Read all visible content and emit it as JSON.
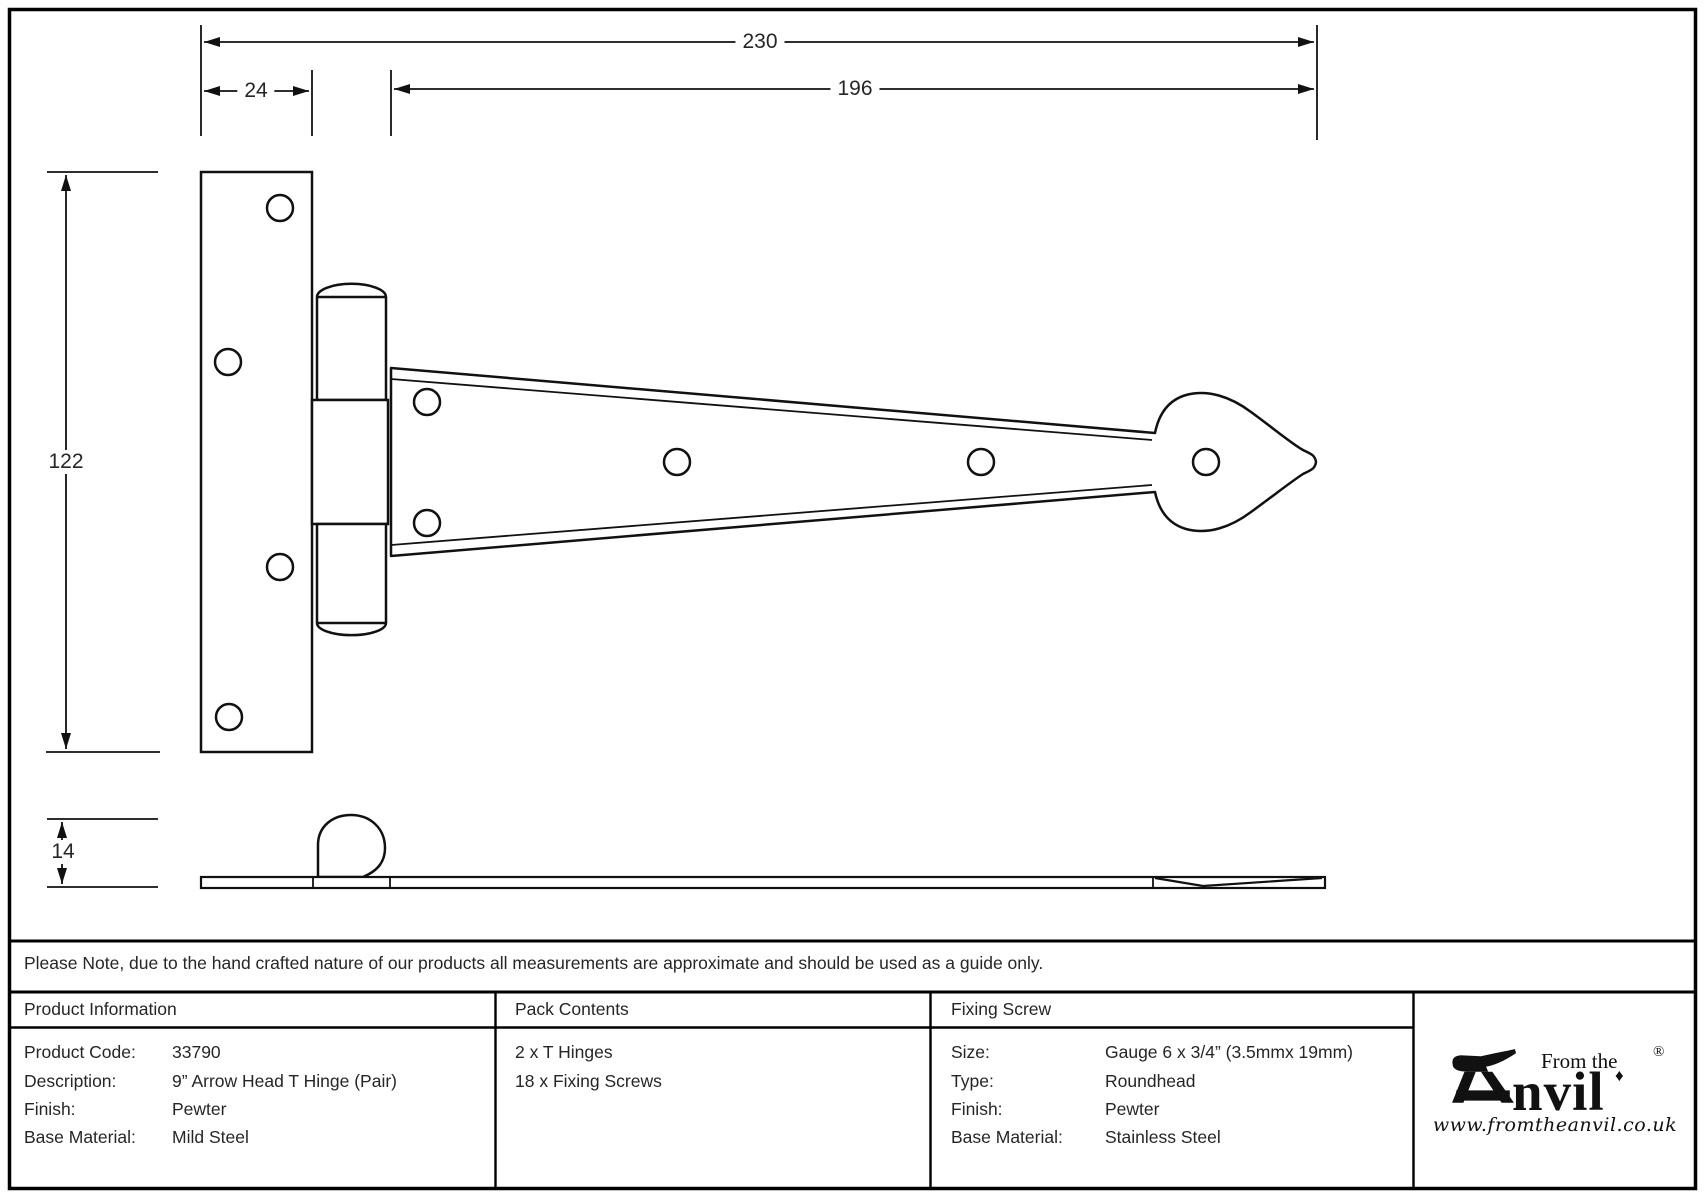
{
  "sheet": {
    "note": "Please Note, due to the hand crafted nature of our products all measurements are approximate and should be used as a guide only."
  },
  "dimensions": {
    "overall_length": "230",
    "plate_width": "24",
    "strap_length": "196",
    "plate_height": "122",
    "thickness": "14"
  },
  "product_information": {
    "title": "Product Information",
    "rows": [
      {
        "label": "Product Code:",
        "value": "33790"
      },
      {
        "label": "Description:",
        "value": "9” Arrow Head T Hinge (Pair)"
      },
      {
        "label": "Finish:",
        "value": "Pewter"
      },
      {
        "label": "Base Material:",
        "value": "Mild Steel"
      }
    ]
  },
  "pack_contents": {
    "title": "Pack Contents",
    "items": [
      "2 x T Hinges",
      "18 x Fixing Screws"
    ]
  },
  "fixing_screw": {
    "title": "Fixing Screw",
    "rows": [
      {
        "label": "Size:",
        "value": "Gauge 6 x 3/4” (3.5mmx 19mm)"
      },
      {
        "label": "Type:",
        "value": "Roundhead"
      },
      {
        "label": "Finish:",
        "value": "Pewter"
      },
      {
        "label": "Base Material:",
        "value": "Stainless Steel"
      }
    ]
  },
  "logo": {
    "prefix": "From the",
    "name_suffix": "nvil",
    "registered": "®",
    "diamond": "♦",
    "website": "www.fromtheanvil.co.uk"
  }
}
